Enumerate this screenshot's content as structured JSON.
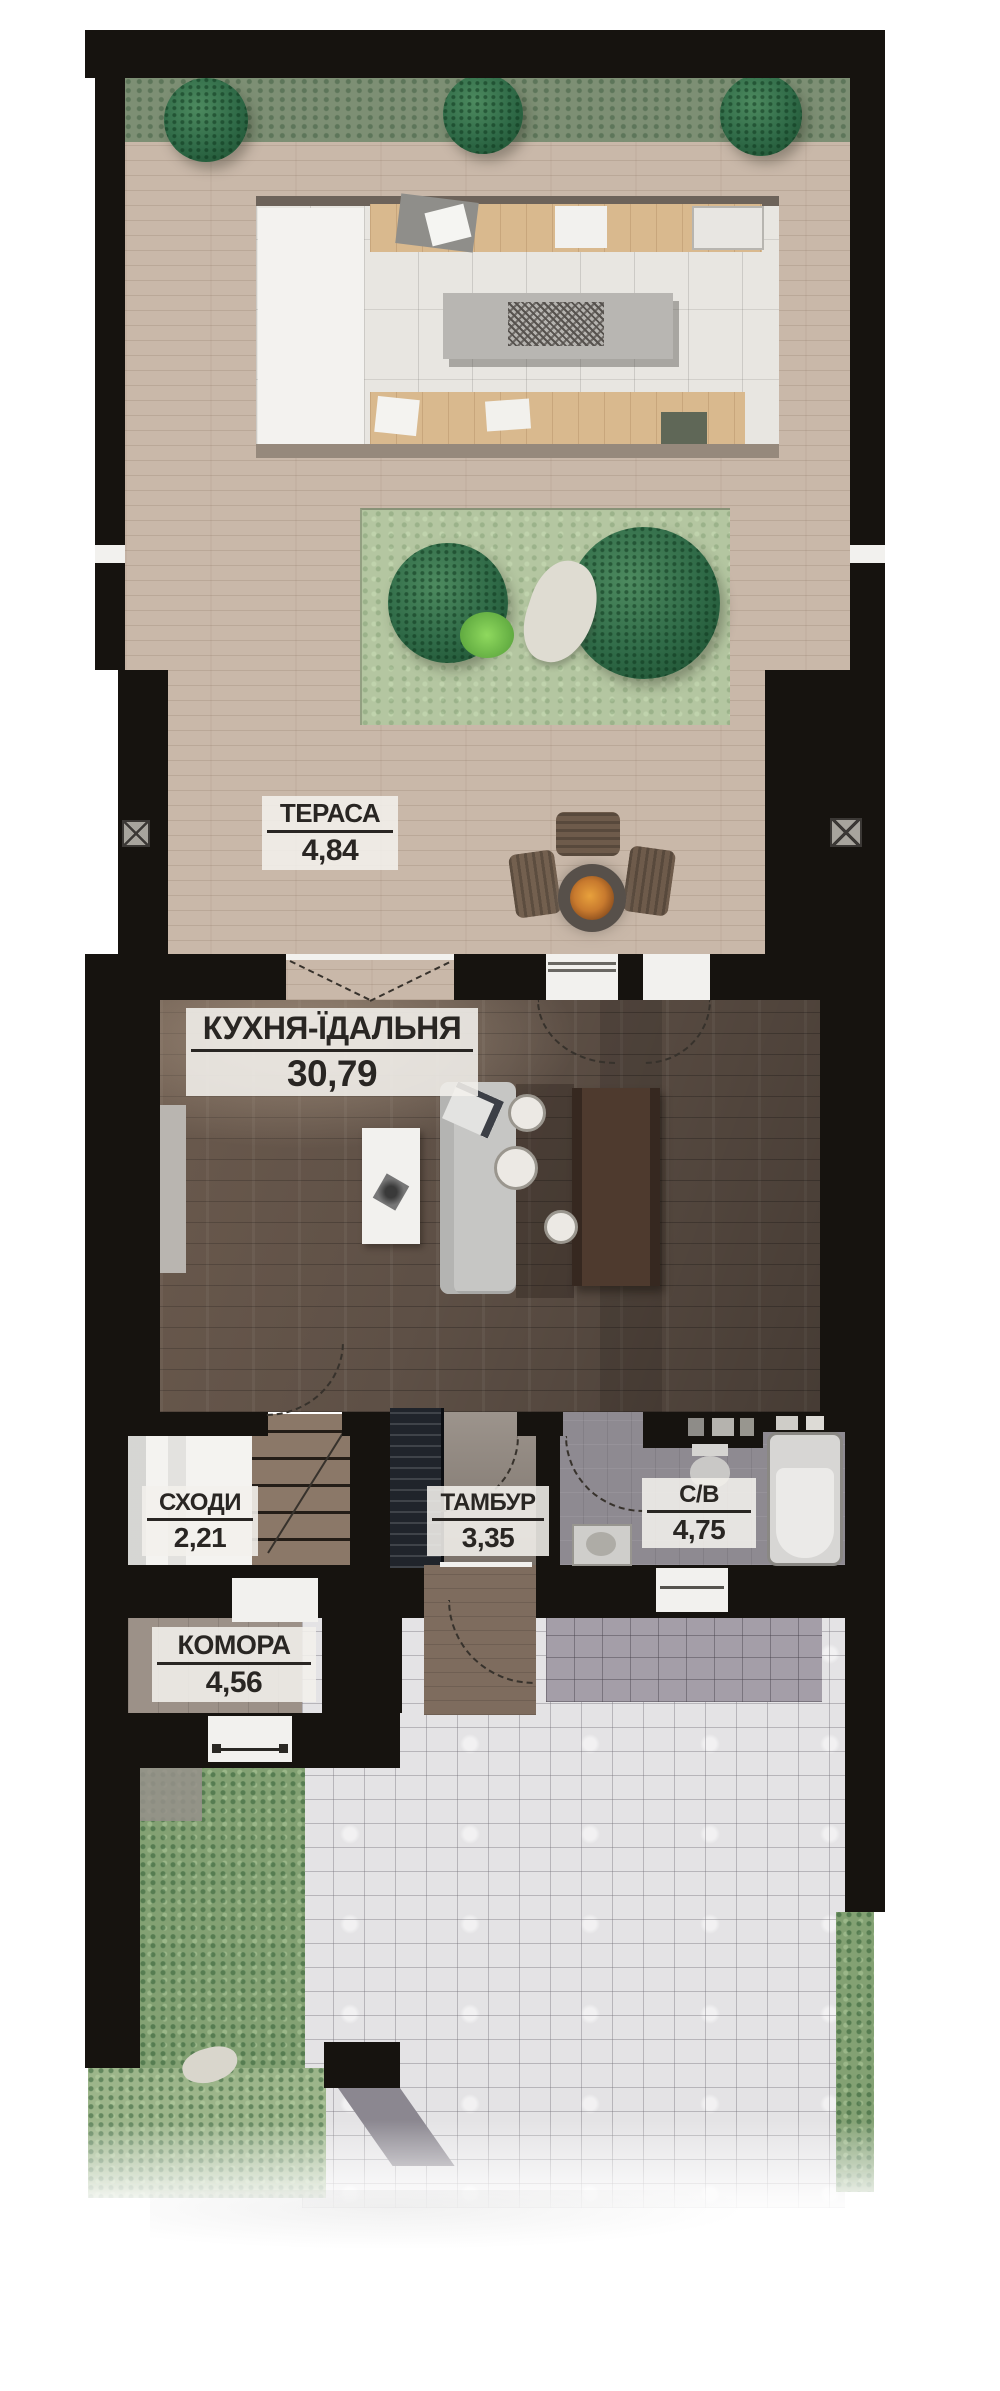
{
  "document": {
    "type": "floor-plan",
    "language": "uk",
    "floor_description": "townhouse ground floor plan with terrace and back yard"
  },
  "rooms": [
    {
      "id": "terrace",
      "name": "ТЕРАСА",
      "area": "4,84"
    },
    {
      "id": "kitchen-dining",
      "name": "КУХНЯ-ЇДАЛЬНЯ",
      "area": "30,79"
    },
    {
      "id": "stairs",
      "name": "СХОДИ",
      "area": "2,21"
    },
    {
      "id": "vestibule",
      "name": "ТАМБУР",
      "area": "3,35"
    },
    {
      "id": "bathroom",
      "name": "С/В",
      "area": "4,75"
    },
    {
      "id": "storage",
      "name": "КОМОРА",
      "area": "4,56"
    }
  ],
  "colors": {
    "walls": "#16130f",
    "deck": "#c9b8a9",
    "hedge": "#7d8f74",
    "tree": "#2f6a47",
    "lawn": "#b4c6a1",
    "kitchen_floor": "#5e5046",
    "pavers_light": "#e4e3e5",
    "pavers_dark": "#a49ea8",
    "grass": "#83a173",
    "label_background": "#f2f0ec",
    "label_text": "#292623",
    "porch": "#7e6c5e",
    "stairs_wood": "#8b7868",
    "fire_glow": "#c87a2e"
  }
}
